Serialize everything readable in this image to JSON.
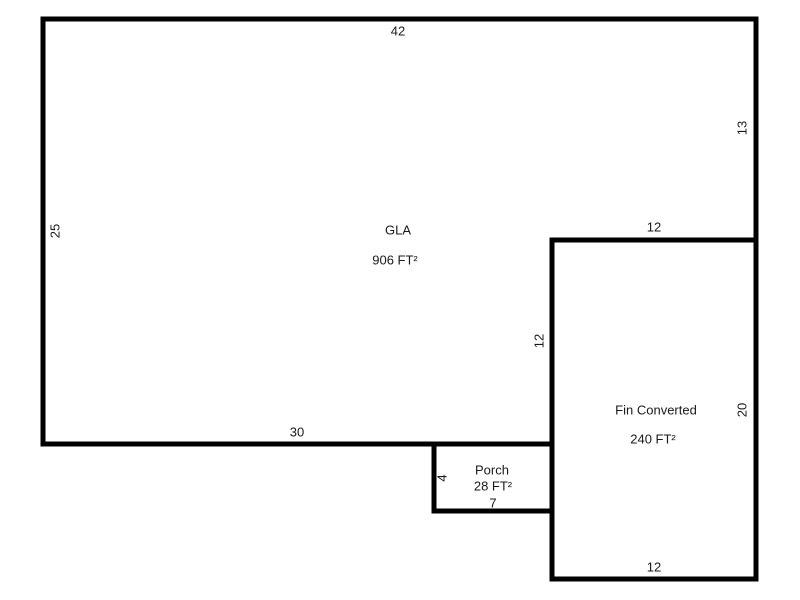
{
  "sketch": {
    "colors": {
      "outline": "#000000",
      "background": "#ffffff",
      "text": "#1a1a1a"
    },
    "gla": {
      "name": "GLA",
      "area": "906 FT²",
      "dim_top": "42",
      "dim_left": "25",
      "dim_right": "13",
      "dim_bottom": "30",
      "dim_notch_vertical": "12"
    },
    "fin_converted": {
      "name": "Fin Converted",
      "area": "240 FT²",
      "dim_top": "12",
      "dim_right": "20",
      "dim_bottom": "12"
    },
    "porch": {
      "name": "Porch",
      "area": "28 FT²",
      "dim_left": "4",
      "dim_bottom": "7"
    }
  }
}
